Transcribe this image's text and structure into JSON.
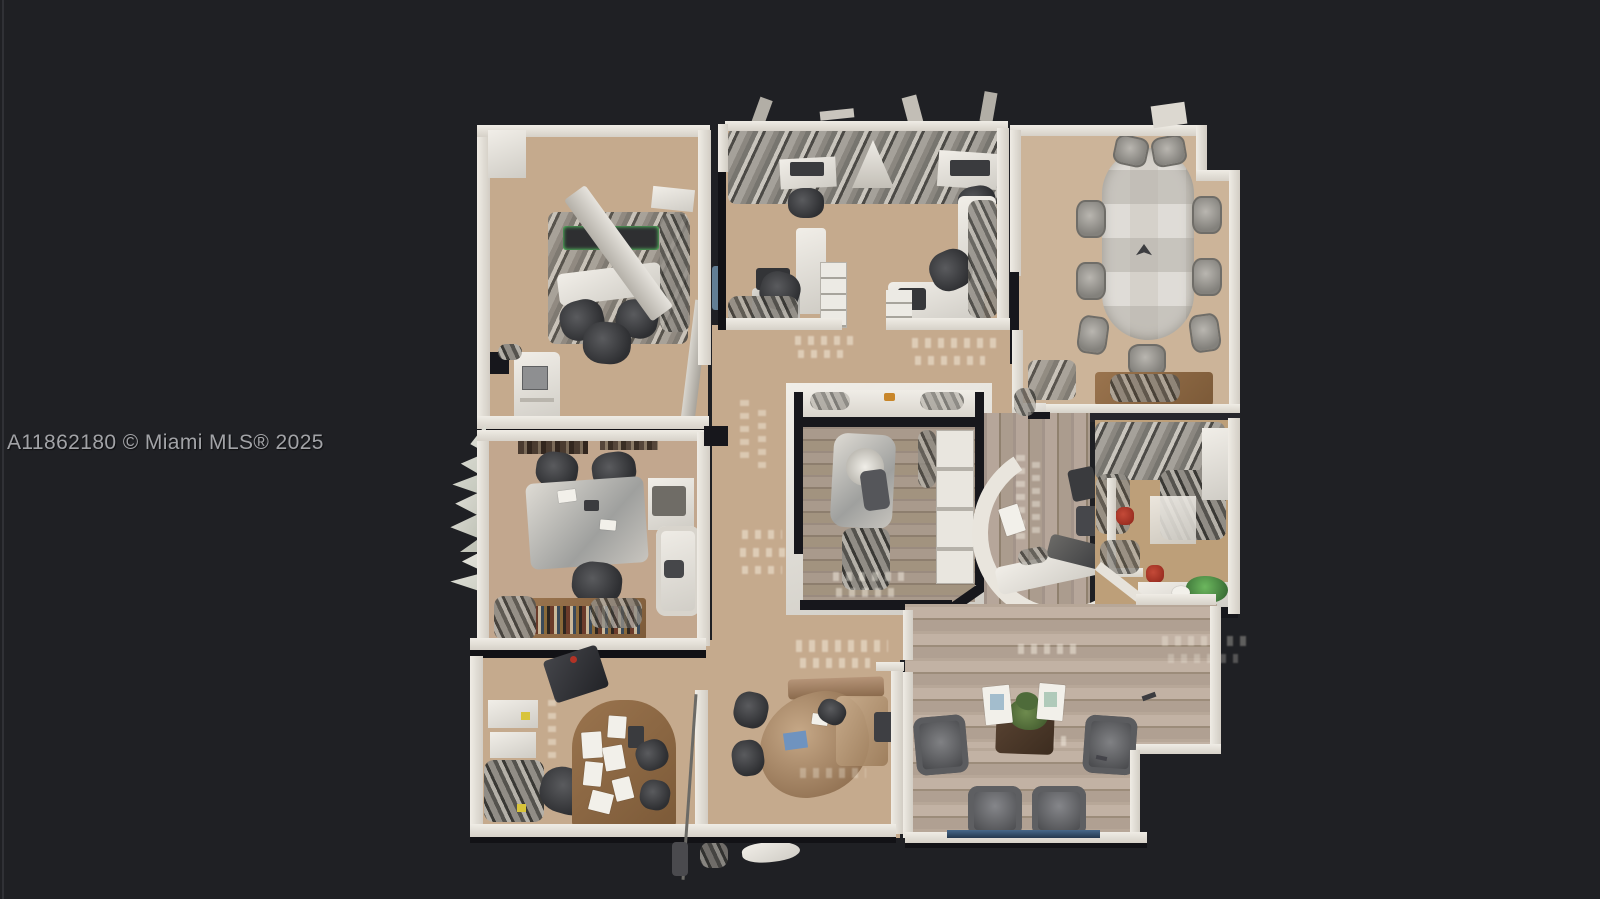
{
  "watermark": {
    "text": "A11862180 © Miami MLS® 2025"
  },
  "palette": {
    "background": "#1f2024",
    "watermark_text": "#a2a3a7",
    "carpet_tan": "#c5aa8d",
    "wood_floor": "#ab9c8e",
    "wall_white": "#e7e3db",
    "interior_wall_dark": "#17171c",
    "entry_door_accent": "#35536f",
    "kitchen_chair_red": "#a93226",
    "plant_green": "#4e6b3a"
  }
}
